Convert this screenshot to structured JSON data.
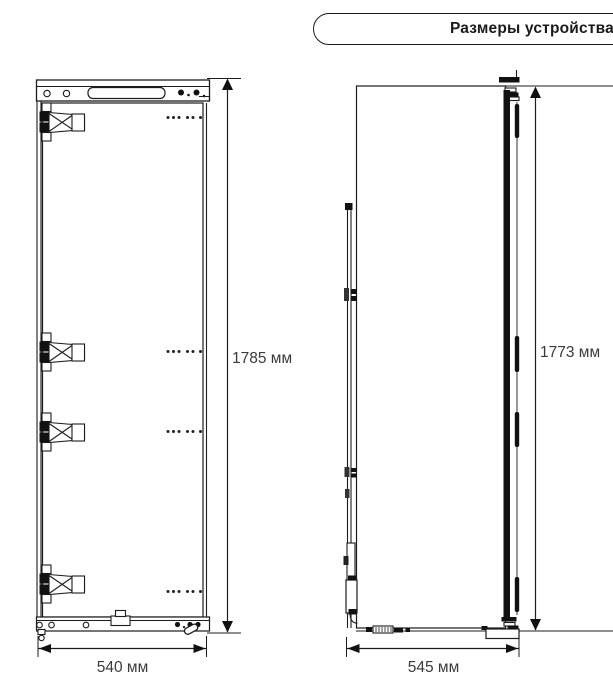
{
  "header": {
    "title": "Размеры устройства"
  },
  "front_view": {
    "height_label": "1785 мм",
    "width_label": "540 мм"
  },
  "side_view": {
    "height_label": "1773 мм",
    "depth_label": "545 мм"
  },
  "colors": {
    "line": "#1c1c1c",
    "text": "#3a3a3a"
  }
}
